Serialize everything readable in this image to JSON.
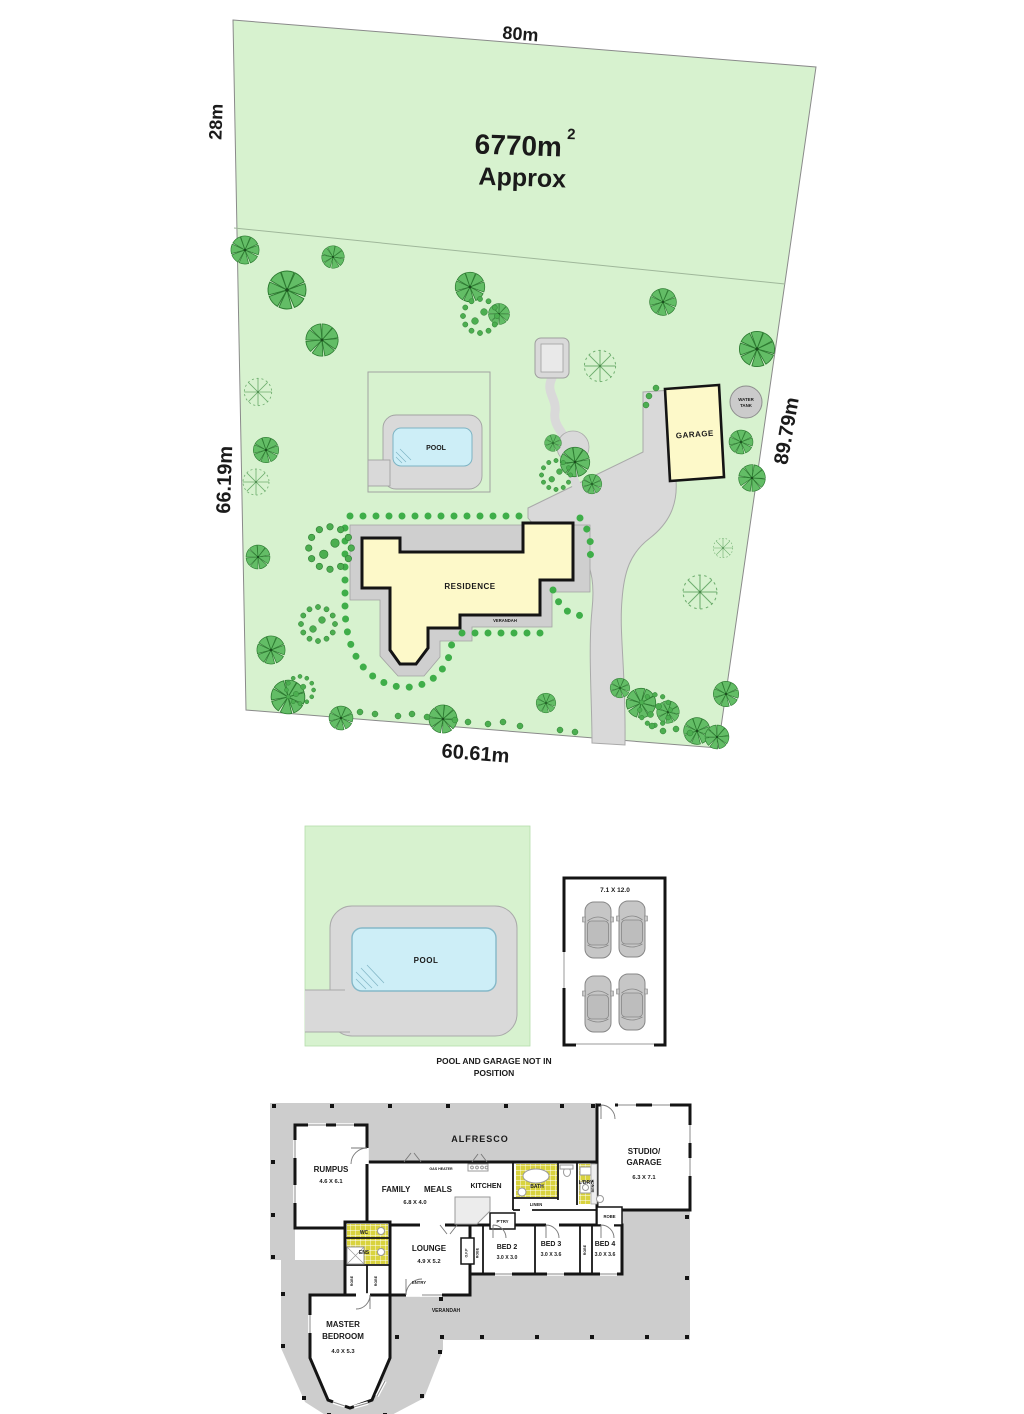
{
  "site_plan": {
    "dim_top": "80m",
    "dim_left_upper": "28m",
    "dim_left_lower": "66.19m",
    "dim_right": "89.79m",
    "dim_bottom": "60.61m",
    "area_value": "6770m",
    "area_sup": "2",
    "area_approx": "Approx",
    "pool": "POOL",
    "garage": "GARAGE",
    "water_tank_line1": "WATER",
    "water_tank_line2": "TANK",
    "residence": "RESIDENCE",
    "verandah": "VERANDAH"
  },
  "detail_plan": {
    "pool": "POOL",
    "garage_size": "7.1 X 12.0",
    "note_line1": "POOL AND GARAGE NOT IN",
    "note_line2": "POSITION"
  },
  "floor_plan": {
    "alfresco": "ALFRESCO",
    "rumpus": "RUMPUS",
    "rumpus_size": "4.6 X 6.1",
    "family": "FAMILY",
    "meals": "MEALS",
    "family_size": "6.8 X 4.0",
    "kitchen": "KITCHEN",
    "gas_heater": "GAS HEATER",
    "bath": "BATH",
    "ldry": "L'DRY",
    "bench": "BENCH",
    "linen": "LINEN",
    "studio_line1": "STUDIO/",
    "studio_line2": "GARAGE",
    "studio_size": "6.3 X 7.1",
    "wc": "WC",
    "ens": "ENS",
    "lounge": "LOUNGE",
    "lounge_size": "4.9 X 5.2",
    "ofp": "O.F.P",
    "ptry": "P'TRY",
    "robe": "ROBE",
    "bed2": "BED 2",
    "bed2_size": "3.0 X 3.0",
    "bed3": "BED 3",
    "bed3_size": "3.0 X 3.6",
    "bed4": "BED 4",
    "bed4_size": "3.0 X 3.6",
    "entry": "ENTRY",
    "verandah": "VERANDAH",
    "master_line1": "MASTER",
    "master_line2": "BEDROOM",
    "master_size": "4.0 X 5.3"
  },
  "colors": {
    "parcel_green": "#d7f2cf",
    "tree_green": "#63bd66",
    "paving_gray": "#d9d9d9",
    "building_yellow": "#fdf9c9",
    "pool_blue": "#cdeef7",
    "deck_gray": "#cdcdcd",
    "tile_yellow": "#d9d33e"
  }
}
